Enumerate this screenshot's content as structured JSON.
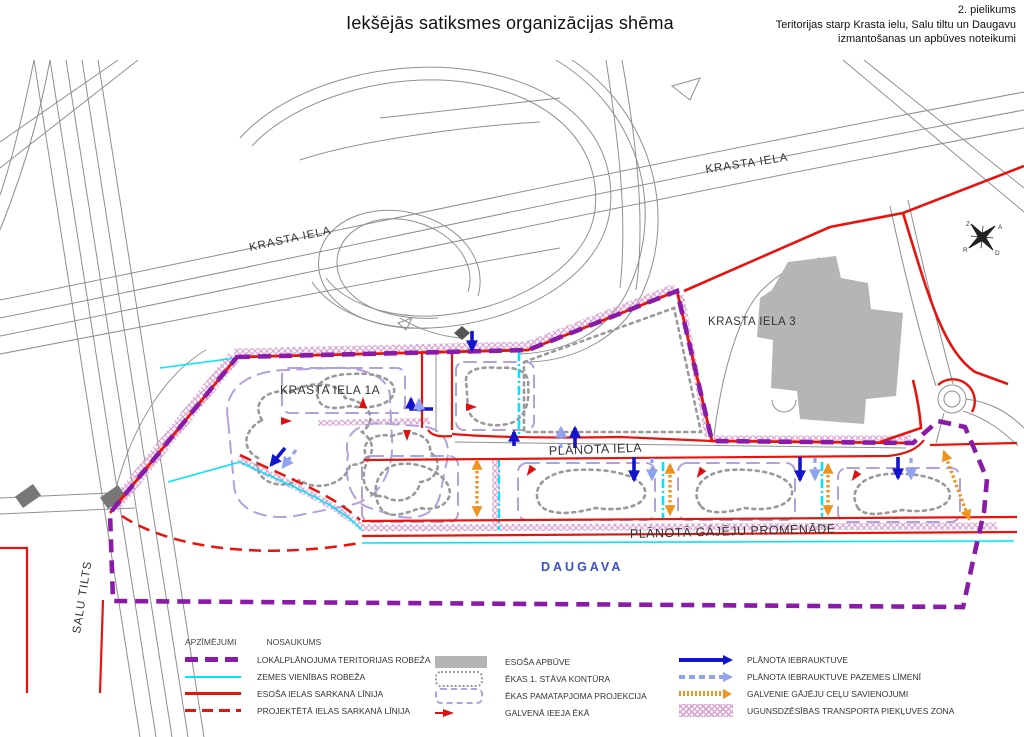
{
  "header": {
    "title": "Iekšējās satiksmes organizācijas shēma",
    "annotation": [
      "2. pielikums",
      "Teritorijas starp Krasta ielu, Salu tiltu un Daugavu",
      "izmantošanas un apbūves noteikumi"
    ]
  },
  "map": {
    "labels": {
      "krasta_nw": "KRASTA IELA",
      "krasta_ne": "KRASTA IELA",
      "krasta3": "KRASTA IELA 3",
      "krasta1a": "KRASTA IELA 1A",
      "planota": "PLĀNOTA IELA",
      "promenade": "PLĀNOTĀ GĀJĒJU PROMENĀDE",
      "daugava": "DAUGAVA",
      "salu_tilts": "SALU TILTS"
    },
    "compass": {
      "n": "Z",
      "e": "A",
      "s": "D",
      "w": "R"
    }
  },
  "legend": {
    "header_symbols": "APZĪMĒJUMI",
    "header_names": "NOSAUKUMS",
    "col1": [
      {
        "symbol": "territory-boundary",
        "label": "LOKĀLPLĀNOJUMA TERITORIJAS ROBEŽA"
      },
      {
        "symbol": "land-unit-boundary",
        "label": "ZEMES VIENĪBAS ROBEŽA"
      },
      {
        "symbol": "existing-red-line",
        "label": "ESOŠA IELAS SARKANĀ LĪNIJA"
      },
      {
        "symbol": "projected-red-line",
        "label": "PROJEKTĒTĀ IELAS SARKANĀ LĪNIJA"
      }
    ],
    "col2": [
      {
        "symbol": "existing-building",
        "label": "ESOŠA APBŪVE"
      },
      {
        "symbol": "first-floor-contour",
        "label": "ĒKAS 1. STĀVA KONTŪRA"
      },
      {
        "symbol": "building-volume-projection",
        "label": "ĒKAS PAMATAPJOMA PROJEKCIJA"
      },
      {
        "symbol": "main-entrance",
        "label": "GALVENĀ IEEJA ĒKĀ"
      }
    ],
    "col3": [
      {
        "symbol": "planned-driveway",
        "label": "PLĀNOTA IEBRAUKTUVE"
      },
      {
        "symbol": "planned-driveway-underground",
        "label": "PLĀNOTA IEBRAUKTUVE PAZEMES LĪMENĪ"
      },
      {
        "symbol": "main-pedestrian-connections",
        "label": "GALVENIE GĀJĒJU CEĻU SAVIENOJUMI"
      },
      {
        "symbol": "fire-access-zone",
        "label": "UGUNSDZĒSĪBAS TRANSPORTA PIEKĻUVES ZONA"
      }
    ]
  },
  "colors": {
    "boundary_purple": "#8A1BA8",
    "red_line": "#E8130C",
    "land_unit_cyan": "#00E5FF",
    "driveway_blue": "#1414CC",
    "underground_blue": "#8FA3EE",
    "pedestrian_orange": "#F0921E",
    "building_gray": "#B5B5B5",
    "contour_gray": "#9A9A9A",
    "projection_purple": "#B3A0DC",
    "hatch_pink": "#D9A6D4",
    "daugava_blue": "#3A4FC8"
  }
}
